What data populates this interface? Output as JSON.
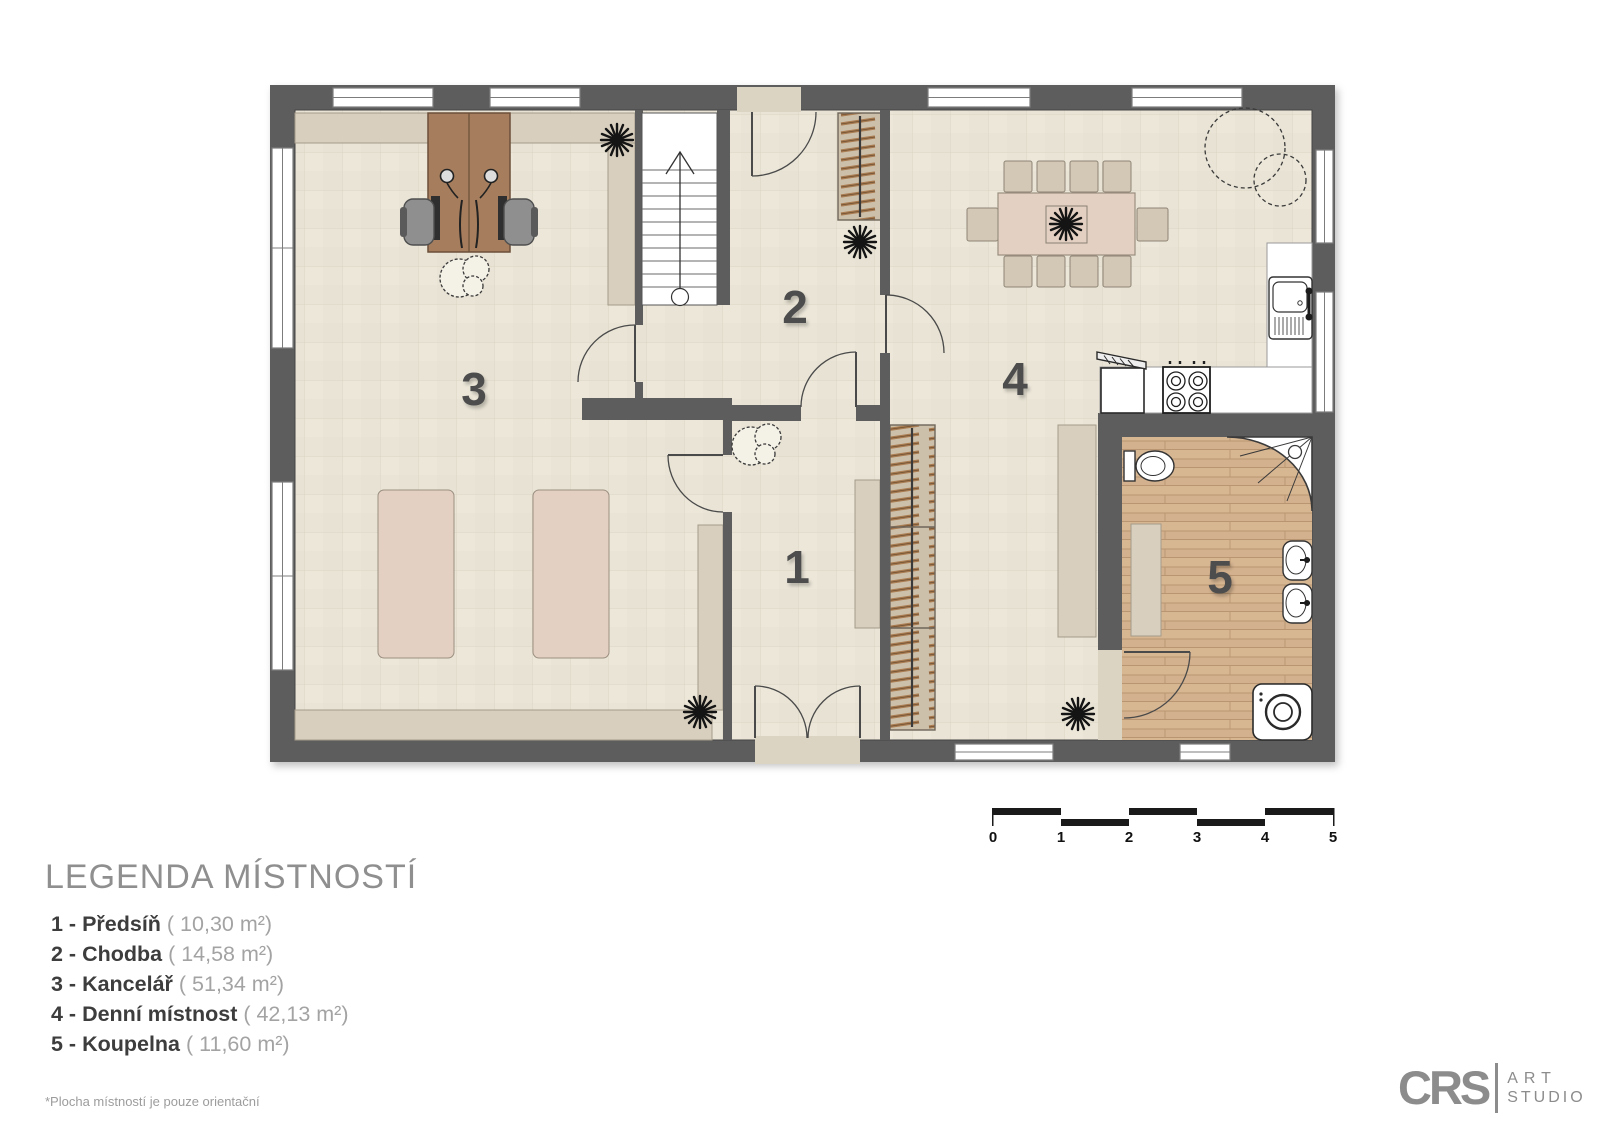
{
  "plan": {
    "rooms": [
      {
        "label": "1"
      },
      {
        "label": "2"
      },
      {
        "label": "3"
      },
      {
        "label": "4"
      },
      {
        "label": "5"
      }
    ]
  },
  "scale_bar": {
    "labels": [
      "0",
      "1",
      "2",
      "3",
      "4",
      "5"
    ]
  },
  "legend": {
    "title": "LEGENDA MÍSTNOSTÍ",
    "items": [
      {
        "label": "1 - Předsíň",
        "area": "( 10,30 m²)"
      },
      {
        "label": "2 - Chodba",
        "area": "( 14,58 m²)"
      },
      {
        "label": "3 - Kancelář",
        "area": "( 51,34 m²)"
      },
      {
        "label": "4 - Denní místnost",
        "area": "( 42,13 m²)"
      },
      {
        "label": "5 - Koupelna",
        "area": "( 11,60 m²)"
      }
    ],
    "footnote": "*Plocha místností je pouze orientační"
  },
  "logo": {
    "brand": "CRS",
    "word1": "ART",
    "word2": "STUDIO"
  },
  "colors": {
    "wall": "#5d5d5d",
    "floor": "#e9e4d6",
    "wood_floor": "#d3b18e",
    "furniture_beige": "#d8cfbf",
    "marble": "#e4d0c2",
    "desk_wood": "#a67e5d",
    "scale_black": "#1a1a1a"
  }
}
